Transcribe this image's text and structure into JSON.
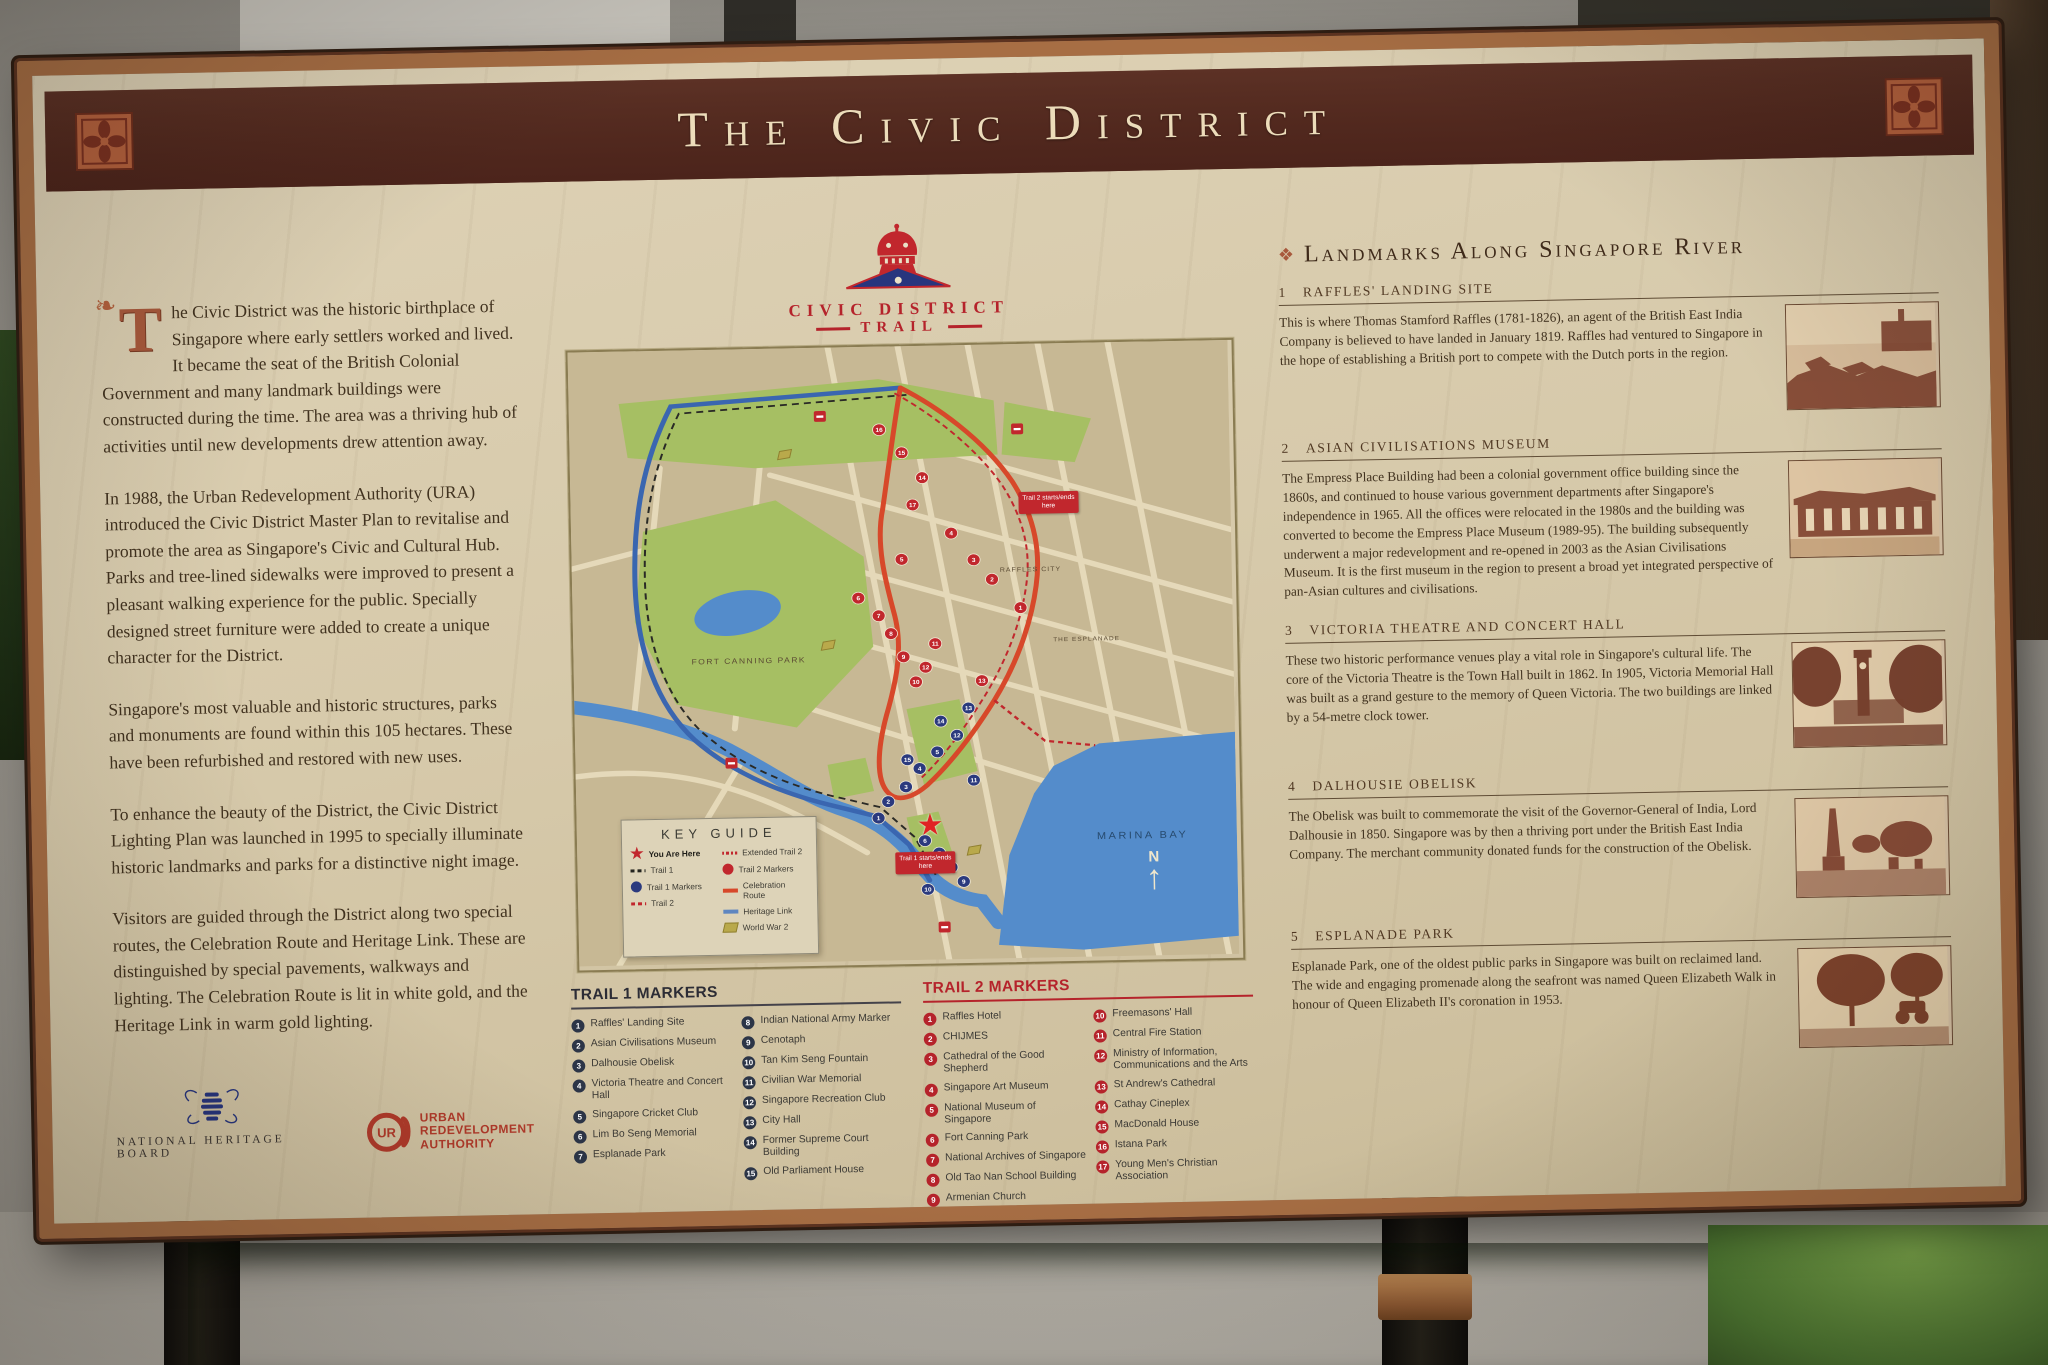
{
  "colors": {
    "frame_copper": "#a76e44",
    "band_maroon": "#53291f",
    "parchment": "#d7caab",
    "accent_red": "#c1272d",
    "heritage_blue": "#3a66b0",
    "celebration_orange": "#d7482a",
    "trail1_badge": "#2c3547",
    "trail2_badge": "#b5232b"
  },
  "sign": {
    "title": "The Civic District",
    "logo": {
      "line1": "CIVIC DISTRICT",
      "line2": "TRAIL"
    },
    "intro": {
      "dropcap": "T",
      "p1": "he Civic District was the historic birthplace of Singapore where early settlers worked and lived. It became the seat of the British Colonial Government and many landmark buildings were constructed during the time. The area was a thriving hub of activities until new developments drew attention away.",
      "p2": "In 1988, the Urban Redevelopment Authority (URA) introduced the Civic District Master Plan to revitalise and promote the area as Singapore's Civic and Cultural Hub. Parks and tree-lined sidewalks were improved to present a pleasant walking experience for the public. Specially designed street furniture were added to create a unique character for the District.",
      "p3": "Singapore's most valuable and historic structures, parks and monuments are found within this 105 hectares. These have been refurbished and restored with new uses.",
      "p4": "To enhance the beauty of the District, the Civic District Lighting Plan was launched in 1995 to specially illuminate historic landmarks and parks for a distinctive night image.",
      "p5": "Visitors are guided through the District along two special routes, the Celebration Route and Heritage Link. These are distinguished by special pavements, walkways and lighting. The Celebration Route is lit in white gold, and the Heritage Link in warm gold lighting."
    },
    "org_logos": {
      "nhb": "NATIONAL HERITAGE BOARD",
      "ura1": "URBAN",
      "ura2": "REDEVELOPMENT",
      "ura3": "AUTHORITY"
    },
    "map": {
      "key_guide": {
        "title": "KEY GUIDE",
        "left": [
          {
            "icon": "you-are-here-star",
            "label": "You Are Here"
          },
          {
            "icon": "trail-1-dash",
            "label": "Trail 1"
          },
          {
            "icon": "trail-1-marker-dot",
            "label": "Trail 1 Markers"
          },
          {
            "icon": "trail-2-dash",
            "label": "Trail 2"
          }
        ],
        "right": [
          {
            "icon": "extended-trail-2-dash",
            "label": "Extended Trail 2"
          },
          {
            "icon": "trail-2-marker-dot",
            "label": "Trail 2 Markers"
          },
          {
            "icon": "celebration-route-line",
            "label": "Celebration Route"
          },
          {
            "icon": "heritage-link-line",
            "label": "Heritage Link"
          },
          {
            "icon": "world-war-2-flag",
            "label": "World War 2"
          }
        ]
      },
      "labels": {
        "fort_canning": "FORT CANNING PARK",
        "raffles_city": "RAFFLES CITY",
        "marina_bay": "MARINA BAY",
        "esplanade": "THE ESPLANADE"
      },
      "annotations": {
        "trail2_start": "Trail 2 starts/ends here",
        "trail1_start": "Trail 1 starts/ends here",
        "compass": "N"
      }
    },
    "trail1": {
      "title": "TRAIL 1 MARKERS",
      "items": [
        {
          "n": "1",
          "label": "Raffles' Landing Site"
        },
        {
          "n": "2",
          "label": "Asian Civilisations Museum"
        },
        {
          "n": "3",
          "label": "Dalhousie Obelisk"
        },
        {
          "n": "4",
          "label": "Victoria Theatre and Concert Hall"
        },
        {
          "n": "5",
          "label": "Singapore Cricket Club"
        },
        {
          "n": "6",
          "label": "Lim Bo Seng Memorial"
        },
        {
          "n": "7",
          "label": "Esplanade Park"
        },
        {
          "n": "8",
          "label": "Indian National Army Marker"
        },
        {
          "n": "9",
          "label": "Cenotaph"
        },
        {
          "n": "10",
          "label": "Tan Kim Seng Fountain"
        },
        {
          "n": "11",
          "label": "Civilian War Memorial"
        },
        {
          "n": "12",
          "label": "Singapore Recreation Club"
        },
        {
          "n": "13",
          "label": "City Hall"
        },
        {
          "n": "14",
          "label": "Former Supreme Court Building"
        },
        {
          "n": "15",
          "label": "Old Parliament House"
        }
      ]
    },
    "trail2": {
      "title": "TRAIL 2 MARKERS",
      "items": [
        {
          "n": "1",
          "label": "Raffles Hotel"
        },
        {
          "n": "2",
          "label": "CHIJMES"
        },
        {
          "n": "3",
          "label": "Cathedral of the Good Shepherd"
        },
        {
          "n": "4",
          "label": "Singapore Art Museum"
        },
        {
          "n": "5",
          "label": "National Museum of Singapore"
        },
        {
          "n": "6",
          "label": "Fort Canning Park"
        },
        {
          "n": "7",
          "label": "National Archives of Singapore"
        },
        {
          "n": "8",
          "label": "Old Tao Nan School Building"
        },
        {
          "n": "9",
          "label": "Armenian Church"
        },
        {
          "n": "10",
          "label": "Freemasons' Hall"
        },
        {
          "n": "11",
          "label": "Central Fire Station"
        },
        {
          "n": "12",
          "label": "Ministry of Information, Communications and the Arts"
        },
        {
          "n": "13",
          "label": "St Andrew's Cathedral"
        },
        {
          "n": "14",
          "label": "Cathay Cineplex"
        },
        {
          "n": "15",
          "label": "MacDonald House"
        },
        {
          "n": "16",
          "label": "Istana Park"
        },
        {
          "n": "17",
          "label": "Young Men's Christian Association"
        }
      ]
    },
    "landmarks": {
      "title": "Landmarks Along Singapore River",
      "sections": [
        {
          "num": "1",
          "heading": "RAFFLES' LANDING SITE",
          "text": "This is where Thomas Stamford Raffles (1781-1826), an agent of the British East India Company is believed to have landed in January 1819. Raffles had ventured to Singapore in the hope of establishing a British port to compete with the Dutch ports in the region."
        },
        {
          "num": "2",
          "heading": "ASIAN CIVILISATIONS MUSEUM",
          "text": "The Empress Place Building had been a colonial government office building since the 1860s, and continued to house various government departments after Singapore's independence in 1965. All the offices were relocated in the 1980s and the building was converted to become the Empress Place Museum (1989-95). The building subsequently underwent a major redevelopment and re-opened in 2003 as the Asian Civilisations Museum. It is the first museum in the region to present a broad yet integrated perspective of pan-Asian cultures and civilisations."
        },
        {
          "num": "3",
          "heading": "VICTORIA THEATRE AND CONCERT HALL",
          "text": "These two historic performance venues play a vital role in Singapore's cultural life. The core of the Victoria Theatre is the Town Hall built in 1862. In 1905, Victoria Memorial Hall was built as a grand gesture to the memory of Queen Victoria. The two buildings are linked by a 54-metre clock tower."
        },
        {
          "num": "4",
          "heading": "DALHOUSIE OBELISK",
          "text": "The Obelisk was built to commemorate the visit of the Governor-General of India, Lord Dalhousie in 1850. Singapore was by then a thriving port under the British East India Company. The merchant community donated funds for the construction of the Obelisk."
        },
        {
          "num": "5",
          "heading": "ESPLANADE PARK",
          "text": "Esplanade Park, one of the oldest public parks in Singapore was built on reclaimed land. The wide and engaging promenade along the seafront was named Queen Elizabeth Walk in honour of Queen Elizabeth II's coronation in 1953."
        }
      ]
    }
  }
}
